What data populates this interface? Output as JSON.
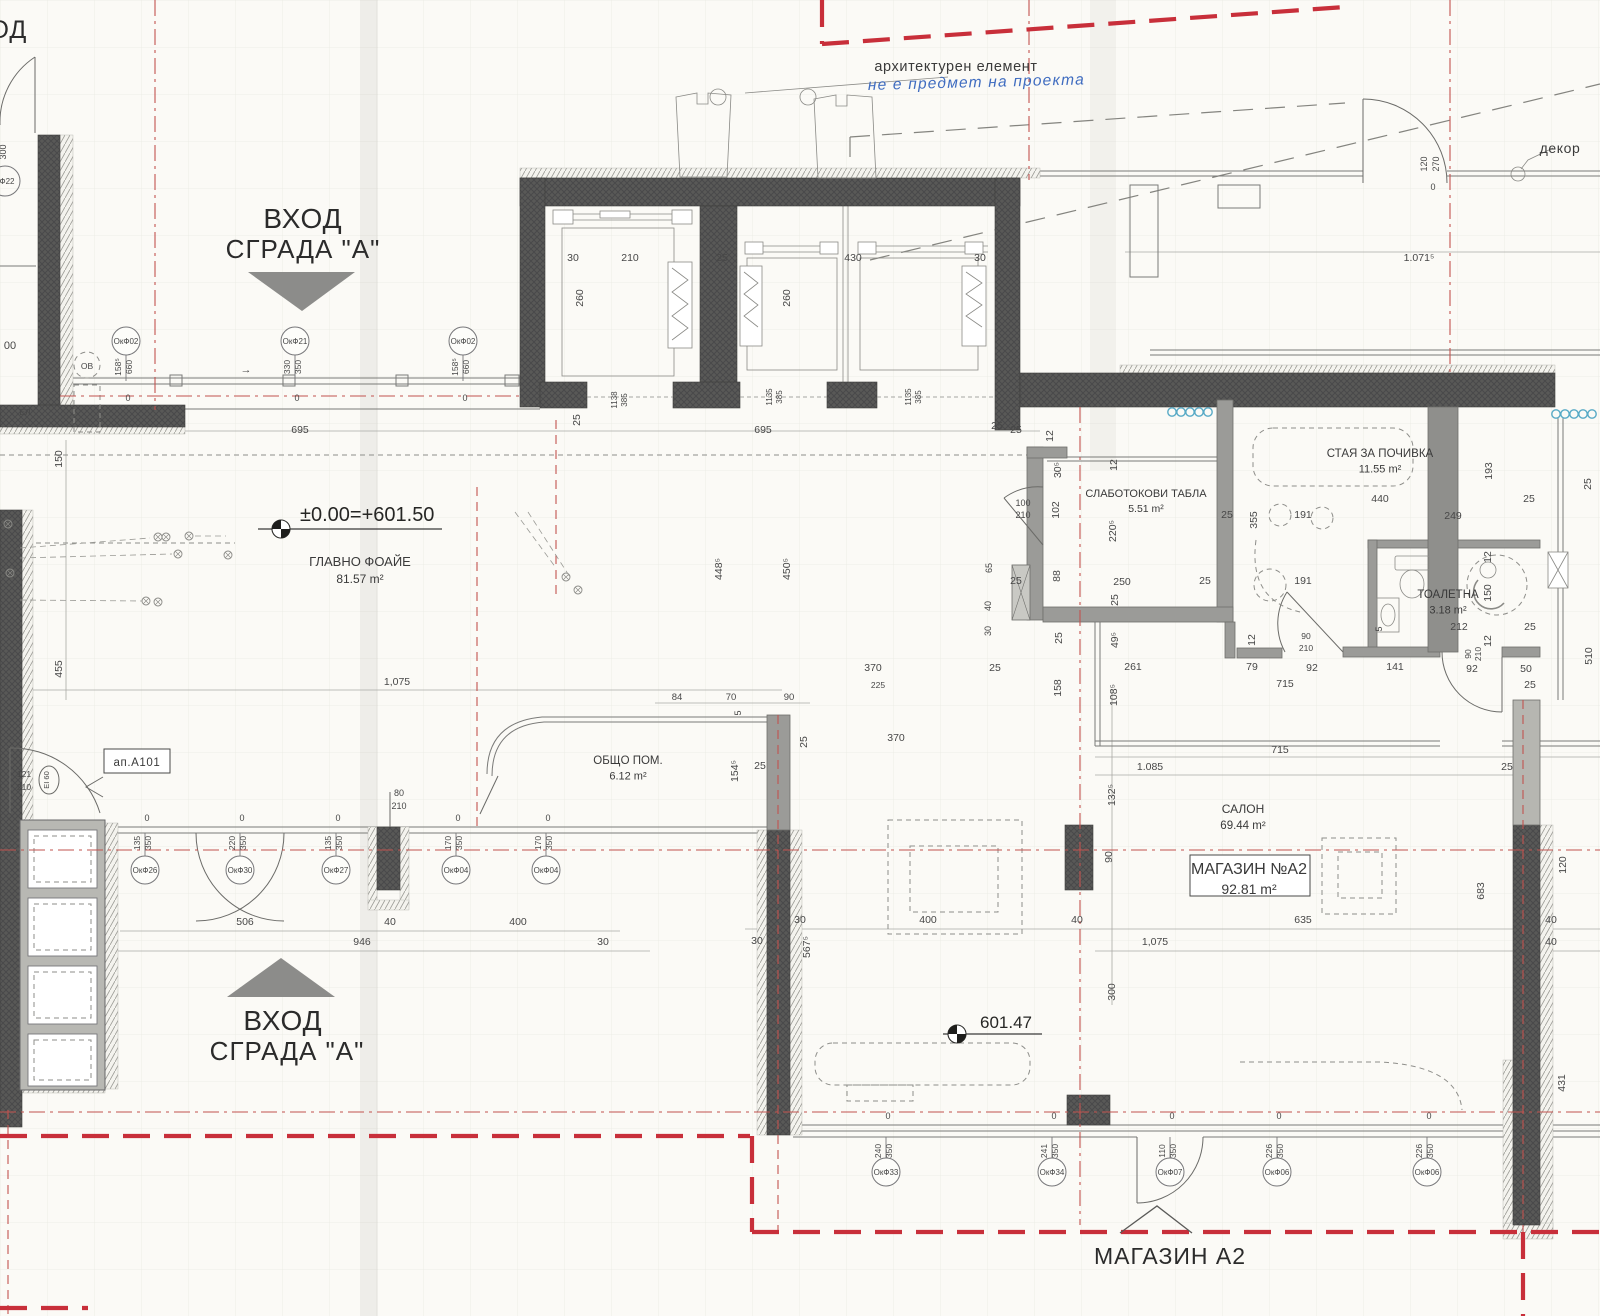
{
  "drawing": {
    "type": "architectural-floor-plan",
    "language": "bg"
  },
  "colors": {
    "paper": "#fbfaf6",
    "wall_dark": "#575755",
    "wall_gray": "#9b9b98",
    "red_centerline": "#c2534f",
    "red_boundary": "#c82f3a",
    "handwriting_blue": "#3f6cc0",
    "glass_cyan": "#58aac6",
    "text": "#3a3a3a"
  },
  "labels": {
    "entrance_top": {
      "line1": "ВХОД",
      "line2": "СГРАДА \"А\""
    },
    "entrance_bottom": {
      "line1": "ВХОД",
      "line2": "СГРАДА \"А\""
    },
    "shop_bottom": "МАГАЗИН А2",
    "arch_element": "архитектурен елемент",
    "handwritten_note": "не е предмет на проекта",
    "decor": "декор",
    "apartment": "ап.А101",
    "el_shaft": "ЕЛ",
    "ov_mark": "ОВ",
    "ei60": "EI 60",
    "f22": "Ф22",
    "hod_partial": "ХОД",
    "partial_00": "00",
    "partial_300": "300"
  },
  "elevations": [
    {
      "text": "±0.00=+601.50",
      "x": 300,
      "y": 521,
      "cx": 281,
      "cy": 529,
      "lx1": 258,
      "lx2": 442,
      "fs": 20
    },
    {
      "text": "601.47",
      "x": 980,
      "y": 1028,
      "cx": 957,
      "cy": 1034,
      "lx1": 943,
      "lx2": 1042,
      "fs": 17
    }
  ],
  "rooms": [
    {
      "name": "ГЛАВНО ФОАЙЕ",
      "area": "81.57 m²",
      "x": 360,
      "y": 566,
      "fs": 13,
      "afs": 12
    },
    {
      "name": "ОБЩО ПОМ.",
      "area": "6.12 m²",
      "x": 628,
      "y": 764,
      "fs": 11.5,
      "afs": 11
    },
    {
      "name": "СЛАБОТОКОВИ ТАБЛА",
      "area": "5.51 m²",
      "x": 1146,
      "y": 497,
      "fs": 11,
      "afs": 10.5
    },
    {
      "name": "СТАЯ ЗА ПОЧИВКА",
      "area": "11.55 m²",
      "x": 1380,
      "y": 457,
      "fs": 11.5,
      "afs": 11
    },
    {
      "name": "ТОАЛЕТНА",
      "area": "3.18 m²",
      "x": 1448,
      "y": 598,
      "fs": 11.5,
      "afs": 11
    },
    {
      "name": "САЛОН",
      "area": "69.44 m²",
      "x": 1243,
      "y": 813,
      "fs": 12,
      "afs": 11.5
    },
    {
      "name": "МАГАЗИН №А2",
      "area": "92.81 m²",
      "x": 1249,
      "y": 874,
      "fs": 16,
      "afs": 14,
      "box": [
        1190,
        855,
        120,
        41
      ]
    }
  ],
  "window_tag_rows": {
    "top": {
      "circle_y": 341,
      "wall_y": 381,
      "dims_y": 367,
      "zero_y": 401
    },
    "foyer": {
      "circle_y": 870,
      "wall_y": 833,
      "dims_y": 843,
      "zero_y": 821
    },
    "shop": {
      "circle_y": 1172,
      "wall_y": 1137,
      "dims_y": 1151,
      "zero_y": 1119
    }
  },
  "window_tags": [
    {
      "label": "ОкФ02",
      "x": 126,
      "row": "top",
      "d1": "158⁵",
      "d2": "660"
    },
    {
      "label": "ОкФ21",
      "x": 295,
      "row": "top",
      "d1": "330",
      "d2": "350"
    },
    {
      "label": "ОкФ02",
      "x": 463,
      "row": "top",
      "d1": "158⁵",
      "d2": "660"
    },
    {
      "label": "ОкФ26",
      "x": 145,
      "row": "foyer",
      "d1": "135",
      "d2": "350"
    },
    {
      "label": "ОкФ30",
      "x": 240,
      "row": "foyer",
      "d1": "220",
      "d2": "350"
    },
    {
      "label": "ОкФ27",
      "x": 336,
      "row": "foyer",
      "d1": "135",
      "d2": "350"
    },
    {
      "label": "ОкФ04",
      "x": 456,
      "row": "foyer",
      "d1": "170",
      "d2": "350"
    },
    {
      "label": "ОкФ04",
      "x": 546,
      "row": "foyer",
      "d1": "170",
      "d2": "350"
    },
    {
      "label": "ОкФ33",
      "x": 886,
      "row": "shop",
      "d1": "240",
      "d2": "350"
    },
    {
      "label": "ОкФ34",
      "x": 1052,
      "row": "shop",
      "d1": "241",
      "d2": "350"
    },
    {
      "label": "ОкФ07",
      "x": 1170,
      "row": "shop",
      "d1": "110",
      "d2": "350"
    },
    {
      "label": "ОкФ06",
      "x": 1277,
      "row": "shop",
      "d1": "226",
      "d2": "350"
    },
    {
      "label": "ОкФ06",
      "x": 1427,
      "row": "shop",
      "d1": "226",
      "d2": "350"
    }
  ],
  "dims": [
    [
      "30",
      573,
      261
    ],
    [
      "210",
      630,
      261
    ],
    [
      "25",
      722,
      261
    ],
    [
      "430",
      853,
      261
    ],
    [
      "30",
      980,
      261
    ],
    [
      "260",
      583,
      298,
      -90
    ],
    [
      "260",
      790,
      298,
      -90
    ],
    [
      "1138",
      617,
      400,
      -90,
      8
    ],
    [
      "385",
      627,
      400,
      -90,
      8
    ],
    [
      "1135",
      772,
      397,
      -90,
      8
    ],
    [
      "385",
      782,
      397,
      -90,
      8
    ],
    [
      "1135",
      911,
      397,
      -90,
      8
    ],
    [
      "385",
      921,
      397,
      -90,
      8
    ],
    [
      "25",
      580,
      420,
      -90
    ],
    [
      "695",
      300,
      433
    ],
    [
      "695",
      763,
      433
    ],
    [
      "25",
      997,
      429
    ],
    [
      "→",
      246,
      373,
      0,
      11
    ],
    [
      "1.071⁵",
      1419,
      261
    ],
    [
      "120",
      1427,
      164,
      -90,
      9
    ],
    [
      "270",
      1439,
      164,
      -90,
      9
    ],
    [
      "0",
      1433,
      190,
      0,
      9
    ],
    [
      "150",
      62,
      459,
      -90
    ],
    [
      "455",
      62,
      669,
      -90
    ],
    [
      "300",
      6,
      152,
      -90,
      9
    ],
    [
      "00",
      10,
      349,
      0,
      11
    ],
    [
      "121",
      24,
      777,
      0,
      8.5
    ],
    [
      "210",
      24,
      790,
      0,
      8.5
    ],
    [
      "80",
      399,
      796,
      0,
      9
    ],
    [
      "210",
      399,
      809,
      0,
      9
    ],
    [
      "1,075",
      397,
      685
    ],
    [
      "448⁵",
      722,
      569,
      -90
    ],
    [
      "450⁵",
      790,
      569,
      -90
    ],
    [
      "370",
      873,
      671
    ],
    [
      "25",
      995,
      671
    ],
    [
      "225",
      878,
      688,
      0,
      8.5
    ],
    [
      "84",
      677,
      700,
      0,
      9.5
    ],
    [
      "70",
      731,
      700,
      0,
      9.5
    ],
    [
      "90",
      789,
      700,
      0,
      9.5
    ],
    [
      "5",
      741,
      713,
      -90,
      9
    ],
    [
      "154⁵",
      738,
      771,
      -90
    ],
    [
      "25",
      760,
      769
    ],
    [
      "25",
      807,
      742,
      -90
    ],
    [
      "370",
      896,
      741
    ],
    [
      "25",
      1016,
      433
    ],
    [
      "12",
      1053,
      436,
      -90
    ],
    [
      "30⁵",
      1061,
      470,
      -90
    ],
    [
      "12",
      1117,
      465,
      -90
    ],
    [
      "100",
      1023,
      506,
      0,
      9
    ],
    [
      "210",
      1023,
      518,
      0,
      9
    ],
    [
      "102",
      1059,
      510,
      -90
    ],
    [
      "220⁵",
      1116,
      531,
      -90
    ],
    [
      "65",
      992,
      568,
      -90,
      9
    ],
    [
      "40",
      991,
      606,
      -90,
      9
    ],
    [
      "30",
      991,
      631,
      -90,
      9
    ],
    [
      "88",
      1060,
      576,
      -90
    ],
    [
      "250",
      1122,
      585
    ],
    [
      "25",
      1205,
      584
    ],
    [
      "25",
      1016,
      584
    ],
    [
      "25",
      1118,
      600,
      -90
    ],
    [
      "25",
      1227,
      518
    ],
    [
      "355",
      1257,
      520,
      -90
    ],
    [
      "191",
      1303,
      518
    ],
    [
      "25",
      1062,
      638,
      -90
    ],
    [
      "49⁵",
      1118,
      640,
      -90
    ],
    [
      "158",
      1061,
      688,
      -90
    ],
    [
      "108⁵",
      1117,
      695,
      -90
    ],
    [
      "261",
      1133,
      670
    ],
    [
      "79",
      1252,
      670
    ],
    [
      "92",
      1312,
      671
    ],
    [
      "715",
      1285,
      687
    ],
    [
      "141",
      1395,
      670
    ],
    [
      "12",
      1255,
      640,
      -90
    ],
    [
      "90",
      1306,
      639,
      0,
      8.5
    ],
    [
      "210",
      1306,
      651,
      0,
      8.5
    ],
    [
      "440",
      1380,
      502
    ],
    [
      "25",
      1529,
      502
    ],
    [
      "249",
      1453,
      519
    ],
    [
      "193",
      1492,
      471,
      -90
    ],
    [
      "191",
      1303,
      584
    ],
    [
      "12",
      1491,
      557,
      -90
    ],
    [
      "150",
      1491,
      593,
      -90
    ],
    [
      "212",
      1459,
      630
    ],
    [
      "25",
      1530,
      630
    ],
    [
      "12",
      1491,
      641,
      -90
    ],
    [
      "5",
      1382,
      629,
      -90,
      9
    ],
    [
      "90",
      1471,
      654,
      -90,
      8.5
    ],
    [
      "210",
      1481,
      654,
      -90,
      8.5
    ],
    [
      "92",
      1472,
      672
    ],
    [
      "50",
      1526,
      672
    ],
    [
      "25",
      1530,
      688
    ],
    [
      "510",
      1592,
      656,
      -90
    ],
    [
      "25",
      1591,
      484,
      -90
    ],
    [
      "715",
      1280,
      753
    ],
    [
      "1.085",
      1150,
      770
    ],
    [
      "25",
      1507,
      770
    ],
    [
      "132⁵",
      1115,
      795,
      -90
    ],
    [
      "90",
      1112,
      857,
      -90
    ],
    [
      "40",
      1077,
      923
    ],
    [
      "635",
      1303,
      923
    ],
    [
      "1,075",
      1155,
      945
    ],
    [
      "300",
      1115,
      992,
      -90
    ],
    [
      "683",
      1484,
      891,
      -90
    ],
    [
      "120",
      1566,
      865,
      -90
    ],
    [
      "40",
      1551,
      923
    ],
    [
      "40",
      1551,
      945
    ],
    [
      "400",
      928,
      923
    ],
    [
      "30",
      800,
      923
    ],
    [
      "30",
      757,
      944
    ],
    [
      "567⁵",
      810,
      947,
      -90
    ],
    [
      "946",
      362,
      945
    ],
    [
      "506",
      245,
      925
    ],
    [
      "40",
      390,
      925
    ],
    [
      "400",
      518,
      925
    ],
    [
      "30",
      603,
      945
    ],
    [
      "431",
      1565,
      1083,
      -90
    ]
  ],
  "symbols": {
    "electrical": [
      [
        158,
        537
      ],
      [
        166,
        537
      ],
      [
        189,
        536
      ],
      [
        178,
        554
      ],
      [
        228,
        555
      ],
      [
        146,
        601
      ],
      [
        158,
        602
      ],
      [
        566,
        577
      ],
      [
        578,
        590
      ],
      [
        8,
        524
      ],
      [
        10,
        573
      ]
    ],
    "leaders": [
      [
        20,
        548,
        150,
        538
      ],
      [
        20,
        558,
        172,
        554
      ],
      [
        20,
        600,
        142,
        601
      ],
      [
        195,
        536,
        226,
        536
      ],
      [
        515,
        512,
        556,
        568
      ],
      [
        528,
        512,
        570,
        577
      ]
    ]
  }
}
